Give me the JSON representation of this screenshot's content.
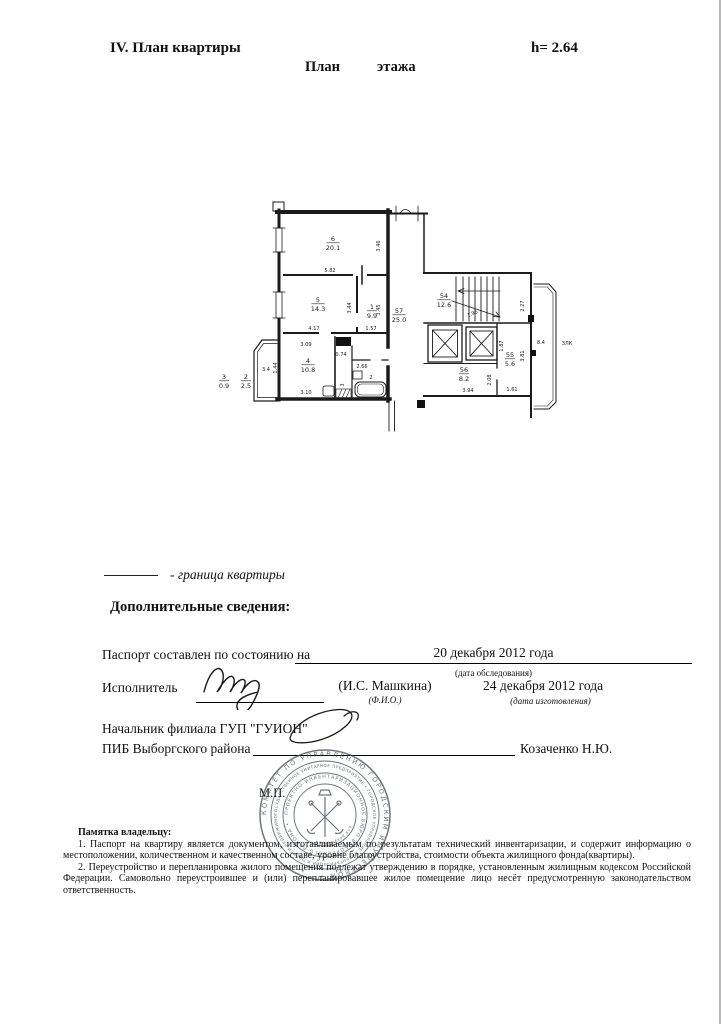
{
  "header": {
    "section_title": "IV. План квартиры",
    "height_note": "h= 2.64",
    "plan_title": {
      "word1": "План",
      "word2": "этажа"
    }
  },
  "plan": {
    "room_labels": [
      {
        "num": "6",
        "area": "20.1",
        "x": 333,
        "y": 241
      },
      {
        "num": "5",
        "area": "14.3",
        "x": 318,
        "y": 302
      },
      {
        "num": "1",
        "area": "9.9",
        "x": 372,
        "y": 309
      },
      {
        "num": "4",
        "area": "10.8",
        "x": 308,
        "y": 363
      },
      {
        "num": "57",
        "area": "25.0",
        "x": 399,
        "y": 313
      },
      {
        "num": "54",
        "area": "12.6",
        "x": 444,
        "y": 298
      },
      {
        "num": "55",
        "area": "5.6",
        "x": 510,
        "y": 357
      },
      {
        "num": "56",
        "area": "8.2",
        "x": 464,
        "y": 372
      },
      {
        "num": "3",
        "area": "0.9",
        "x": 224,
        "y": 379
      },
      {
        "num": "2",
        "area": "2.5",
        "x": 246,
        "y": 379
      }
    ],
    "dim_labels": [
      {
        "t": "5.82",
        "x": 330,
        "y": 272
      },
      {
        "t": "3.46",
        "x": 380,
        "y": 246,
        "r": -90
      },
      {
        "t": "4.17",
        "x": 314,
        "y": 330
      },
      {
        "t": "1.57",
        "x": 371,
        "y": 330
      },
      {
        "t": "3.44",
        "x": 351,
        "y": 308,
        "r": -90
      },
      {
        "t": "3.45",
        "x": 380,
        "y": 310,
        "r": -90
      },
      {
        "t": "3.09",
        "x": 306,
        "y": 346
      },
      {
        "t": "0.74",
        "x": 341,
        "y": 356
      },
      {
        "t": "2.66",
        "x": 362,
        "y": 368
      },
      {
        "t": "3.10",
        "x": 306,
        "y": 394
      },
      {
        "t": "1.44",
        "x": 277,
        "y": 368,
        "r": -90
      },
      {
        "t": "3.4",
        "x": 266,
        "y": 371,
        "s": 6
      },
      {
        "t": "2",
        "x": 371,
        "y": 379,
        "s": 6.5
      },
      {
        "t": "3",
        "x": 344,
        "y": 385,
        "r": -90,
        "s": 6
      },
      {
        "t": "2.27",
        "x": 524,
        "y": 306,
        "r": -90
      },
      {
        "t": "1.95",
        "x": 473,
        "y": 315,
        "r": -22,
        "s": 4.5
      },
      {
        "t": "1.87",
        "x": 503,
        "y": 346,
        "r": -90
      },
      {
        "t": "3.81",
        "x": 524,
        "y": 356,
        "r": -90
      },
      {
        "t": "2.08",
        "x": 491,
        "y": 380,
        "r": -90
      },
      {
        "t": "3.94",
        "x": 468,
        "y": 392
      },
      {
        "t": "1.61",
        "x": 512,
        "y": 391
      },
      {
        "t": "8.4",
        "x": 541,
        "y": 344,
        "s": 6
      },
      {
        "t": "ЗЛК",
        "x": 567,
        "y": 345,
        "s": 7
      }
    ]
  },
  "legend": {
    "boundary_label": "- граница квартиры"
  },
  "sections": {
    "additional_info_title": "Дополнительные сведения:"
  },
  "passport": {
    "compiled_label": "Паспорт составлен по состоянию на",
    "survey_date": "20 декабря 2012 года",
    "survey_date_caption": "(дата обследования)",
    "executor_label": "Исполнитель",
    "executor_name": "(И.С. Машкина)",
    "executor_name_caption": "(Ф.И.О.)",
    "production_date": "24 декабря 2012 года",
    "production_date_caption": "(дата изготовления)",
    "chief_title_line1": "Начальник филиала ГУП \"ГУИОН\"",
    "chief_title_line2": "ПИБ Выборгского района",
    "chief_name": "Козаченко Н.Ю.",
    "stamp_place_label": "М.П."
  },
  "stamp": {
    "outer_ring": "КОМИТЕТ ПО УПРАВЛЕНИЮ ГОРОДСКИМ ИМУЩЕСТВОМ • ",
    "middle_ring": "ГОСУДАРСТВЕННОЕ УНИТАРНОЕ ПРЕДПРИЯТИЕ • ГОРОДСКОЕ УПРАВЛЕНИЕ ИНВЕНТАРИЗАЦИИ И ОЦЕНКИ НЕДВИЖИМОСТИ •",
    "inner_ring": "ПРОЕКТНО-ИНВЕНТАРИЗАЦИОННОЕ БЮРО ВЫБОРГСКОГО РАЙОНА •",
    "center_note": "для документов",
    "ink_color": "#4b5560"
  },
  "memo": {
    "title": "Памятка владельцу:",
    "items": [
      "1. Паспорт на квартиру является документом, изготавливаемым по результатам технический инвентаризации, и содержит информацию о местоположении, количественном и качественном составе, уровне благоустройства, стоимости объекта жилищного фонда(квартиры).",
      "2. Переустройство и перепланировка жилого помещения подлежат утверждению в порядке, установленным жилищным кодексом Российской Федерации. Самовольно переустроившее и (или) перепланировавшее жилое помещение лицо несёт предусмотренную законодательством ответственность."
    ]
  }
}
